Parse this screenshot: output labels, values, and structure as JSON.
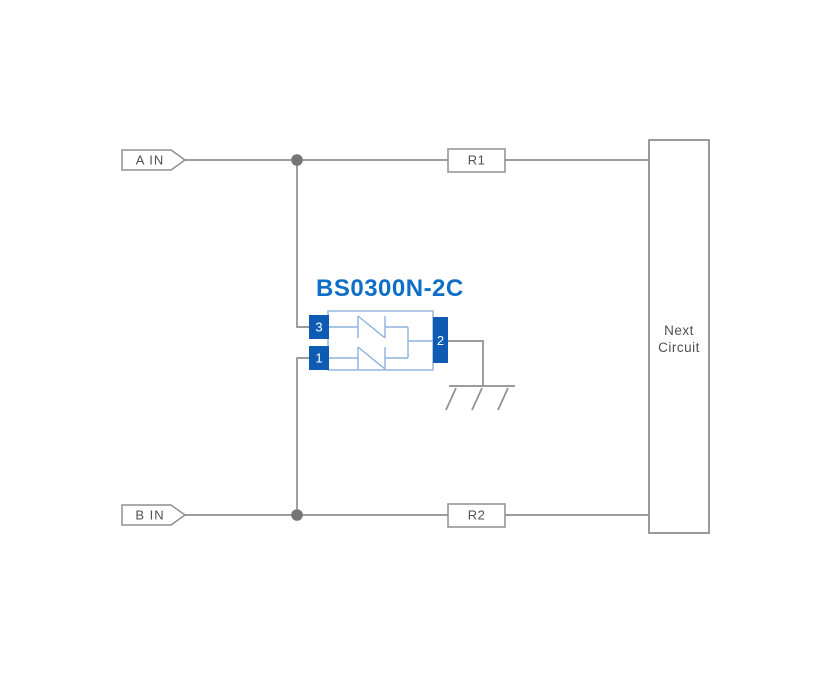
{
  "diagram": {
    "component": {
      "title": "BS0300N-2C",
      "pins": [
        {
          "number": "3"
        },
        {
          "number": "1"
        },
        {
          "number": "2"
        }
      ]
    },
    "inputs": [
      {
        "label": "A IN"
      },
      {
        "label": "B IN"
      }
    ],
    "resistors": [
      {
        "label": "R1"
      },
      {
        "label": "R2"
      }
    ],
    "next_circuit": {
      "lines": [
        "Next",
        "Circuit"
      ]
    }
  },
  "colors": {
    "wire": "#8f8f8f",
    "junction": "#757575",
    "label-text": "#515151",
    "pin-blue": "#0e5bb4",
    "component-outline": "#8fb2de",
    "title-blue": "#0f6ec6",
    "background": "#ffffff"
  }
}
